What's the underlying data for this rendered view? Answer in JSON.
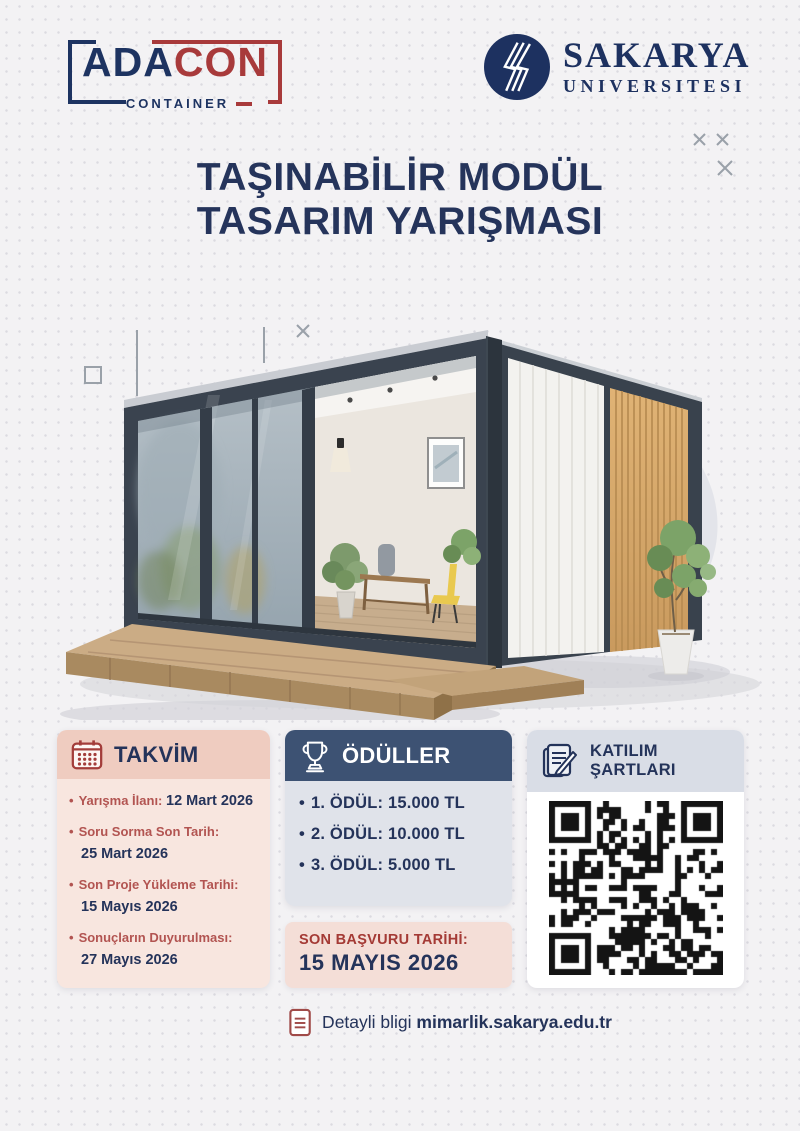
{
  "header": {
    "adacon": {
      "ada": "ADA",
      "con": "CON",
      "subtitle": "CONTAINER"
    },
    "sakarya": {
      "name": "SAKARYA",
      "subtitle": "UNIVERSITESI"
    }
  },
  "title": {
    "line1": "TAŞINABİLİR MODÜL",
    "line2": "TASARIM YARIŞMASI"
  },
  "takvim": {
    "title": "TAKVİM",
    "icon": "calendar-icon",
    "items": [
      {
        "label": "Yarışma İlanı:",
        "date": "12 Mart 2026"
      },
      {
        "label": "Soru Sorma Son Tarih:",
        "date": "25 Mart 2026"
      },
      {
        "label": "Son Proje Yükleme Tarihi:",
        "date": "15 Mayıs 2026"
      },
      {
        "label": "Sonuçların Duyurulması:",
        "date": "27 Mayıs 2026"
      }
    ]
  },
  "oduller": {
    "title": "ÖDÜLLER",
    "icon": "trophy-icon",
    "items": [
      "1. ÖDÜL: 15.000 TL",
      "2. ÖDÜL: 10.000 TL",
      "3. ÖDÜL: 5.000 TL"
    ]
  },
  "katilim": {
    "title_line1": "KATILIM",
    "title_line2": "ŞARTLARI",
    "icon": "document-pencil-icon",
    "qr": "qr-code"
  },
  "son_basvuru": {
    "label": "SON BAŞVURU TARİHİ:",
    "date": "15 MAYIS 2026"
  },
  "footer": {
    "prefix": "Detayli bligi ",
    "link": "mimarlik.sakarya.edu.tr",
    "icon": "document-icon"
  },
  "colors": {
    "navy": "#24335a",
    "red": "#a83a3b",
    "takvim_header": "#efccc0",
    "takvim_body": "#f8e6df",
    "oduller_header": "#3d5273",
    "oduller_body": "#e0e3ea",
    "katilim_header": "#d9dde6",
    "background": "#f3f2f4"
  }
}
